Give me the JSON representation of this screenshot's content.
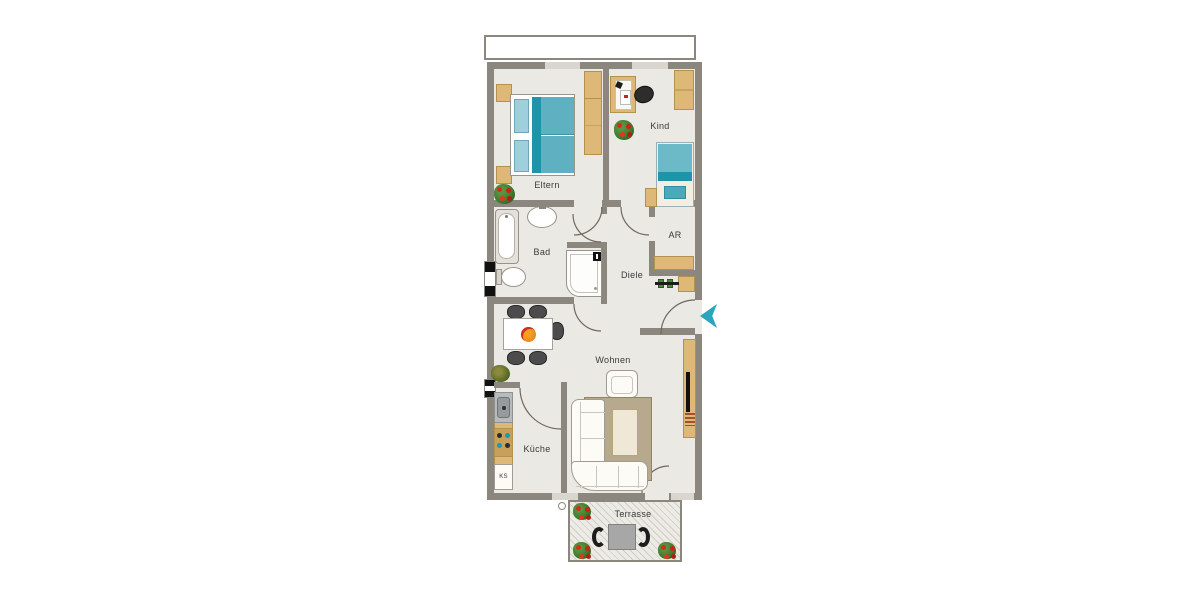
{
  "rooms": {
    "eltern": "Eltern",
    "kind": "Kind",
    "bad": "Bad",
    "diele": "Diele",
    "ar": "AR",
    "wohnen": "Wohnen",
    "kueche": "Küche",
    "terrasse": "Terrasse"
  },
  "labels": {
    "fridge": "KS"
  },
  "colors": {
    "wall": "#8b867e",
    "floor": "#ebe9e3",
    "wood": "#ddb877",
    "wood_border": "#b3914f",
    "teal_dark": "#1f93a8",
    "teal": "#5fb1c2",
    "teal_light": "#9fcfdc",
    "rug": "#b7a98e",
    "arrow": "#2aa5bb",
    "plant_red": "#d22d1a",
    "plant_green": "#3f7c2e"
  }
}
